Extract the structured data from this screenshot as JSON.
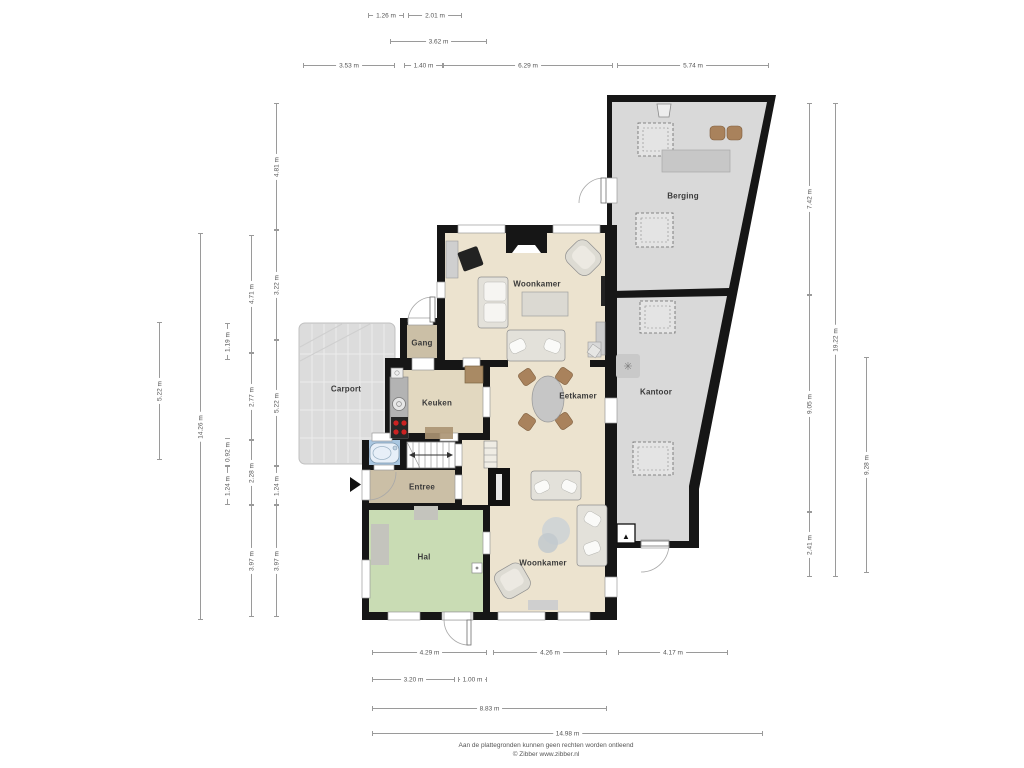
{
  "plan_title": "Begane grond plattegrond",
  "rooms": [
    {
      "label": "Berging",
      "x": 683,
      "y": 196
    },
    {
      "label": "Woonkamer",
      "x": 537,
      "y": 284
    },
    {
      "label": "Gang",
      "x": 422,
      "y": 343
    },
    {
      "label": "Carport",
      "x": 346,
      "y": 389
    },
    {
      "label": "Keuken",
      "x": 437,
      "y": 403
    },
    {
      "label": "Eetkamer",
      "x": 578,
      "y": 396
    },
    {
      "label": "Kantoor",
      "x": 656,
      "y": 392
    },
    {
      "label": "Entree",
      "x": 422,
      "y": 487
    },
    {
      "label": "Hal",
      "x": 424,
      "y": 557
    },
    {
      "label": "Woonkamer",
      "x": 543,
      "y": 563
    }
  ],
  "dimensions": {
    "horizontal": [
      {
        "label": "1.26 m",
        "x1": 368,
        "x2": 404,
        "y": 15
      },
      {
        "label": "2.01 m",
        "x1": 408,
        "x2": 462,
        "y": 15
      },
      {
        "label": "3.62 m",
        "x1": 390,
        "x2": 487,
        "y": 41
      },
      {
        "label": "3.53 m",
        "x1": 303,
        "x2": 395,
        "y": 65
      },
      {
        "label": "1.40 m",
        "x1": 404,
        "x2": 443,
        "y": 65
      },
      {
        "label": "6.29 m",
        "x1": 443,
        "x2": 613,
        "y": 65
      },
      {
        "label": "5.74 m",
        "x1": 617,
        "x2": 769,
        "y": 65
      },
      {
        "label": "4.29 m",
        "x1": 372,
        "x2": 487,
        "y": 652
      },
      {
        "label": "4.26 m",
        "x1": 493,
        "x2": 607,
        "y": 652
      },
      {
        "label": "4.17 m",
        "x1": 618,
        "x2": 728,
        "y": 652
      },
      {
        "label": "3.20 m",
        "x1": 372,
        "x2": 455,
        "y": 679
      },
      {
        "label": "1.00 m",
        "x1": 458,
        "x2": 487,
        "y": 679
      },
      {
        "label": "8.83 m",
        "x1": 372,
        "x2": 607,
        "y": 708
      },
      {
        "label": "14.98 m",
        "x1": 372,
        "x2": 763,
        "y": 733
      }
    ],
    "vertical": [
      {
        "label": "5.22 m",
        "x": 159,
        "y1": 322,
        "y2": 460
      },
      {
        "label": "14.26 m",
        "x": 200,
        "y1": 233,
        "y2": 620
      },
      {
        "label": "1.19 m",
        "x": 227,
        "y1": 323,
        "y2": 360
      },
      {
        "label": "0.92 m",
        "x": 227,
        "y1": 438,
        "y2": 466
      },
      {
        "label": "1.24 m",
        "x": 227,
        "y1": 466,
        "y2": 505
      },
      {
        "label": "4.71 m",
        "x": 251,
        "y1": 235,
        "y2": 353
      },
      {
        "label": "2.77 m",
        "x": 251,
        "y1": 353,
        "y2": 440
      },
      {
        "label": "2.28 m",
        "x": 251,
        "y1": 440,
        "y2": 505
      },
      {
        "label": "3.97 m",
        "x": 251,
        "y1": 505,
        "y2": 617
      },
      {
        "label": "4.81 m",
        "x": 276,
        "y1": 103,
        "y2": 230
      },
      {
        "label": "3.22 m",
        "x": 276,
        "y1": 230,
        "y2": 340
      },
      {
        "label": "5.22 m",
        "x": 276,
        "y1": 340,
        "y2": 466
      },
      {
        "label": "1.24 m",
        "x": 276,
        "y1": 466,
        "y2": 505
      },
      {
        "label": "3.97 m",
        "x": 276,
        "y1": 505,
        "y2": 617
      },
      {
        "label": "7.42 m",
        "x": 809,
        "y1": 103,
        "y2": 295
      },
      {
        "label": "9.05 m",
        "x": 809,
        "y1": 295,
        "y2": 512
      },
      {
        "label": "2.41 m",
        "x": 809,
        "y1": 512,
        "y2": 577
      },
      {
        "label": "19.22 m",
        "x": 835,
        "y1": 103,
        "y2": 577
      },
      {
        "label": "9.28 m",
        "x": 866,
        "y1": 357,
        "y2": 573
      }
    ]
  },
  "icons": {
    "fan_glyph": "✳",
    "entry_glyph": "▲"
  },
  "footer": {
    "line1": "Aan de plattegronden kunnen geen rechten worden ontleend",
    "line2": "© Zibber www.zibber.nl"
  },
  "colors": {
    "wall": "#161616",
    "floor_living": "#ece3cf",
    "floor_hall_tan": "#cbbfa6",
    "floor_kitchen": "#e2d8c0",
    "floor_hal_green": "#c9dcb4",
    "floor_bath_blue": "#a9c6e0",
    "floor_gray": "#d9d9d9",
    "chair_brown": "#a9825c",
    "burner_red": "#cc2222",
    "dimension_line": "#9a9a9a"
  }
}
